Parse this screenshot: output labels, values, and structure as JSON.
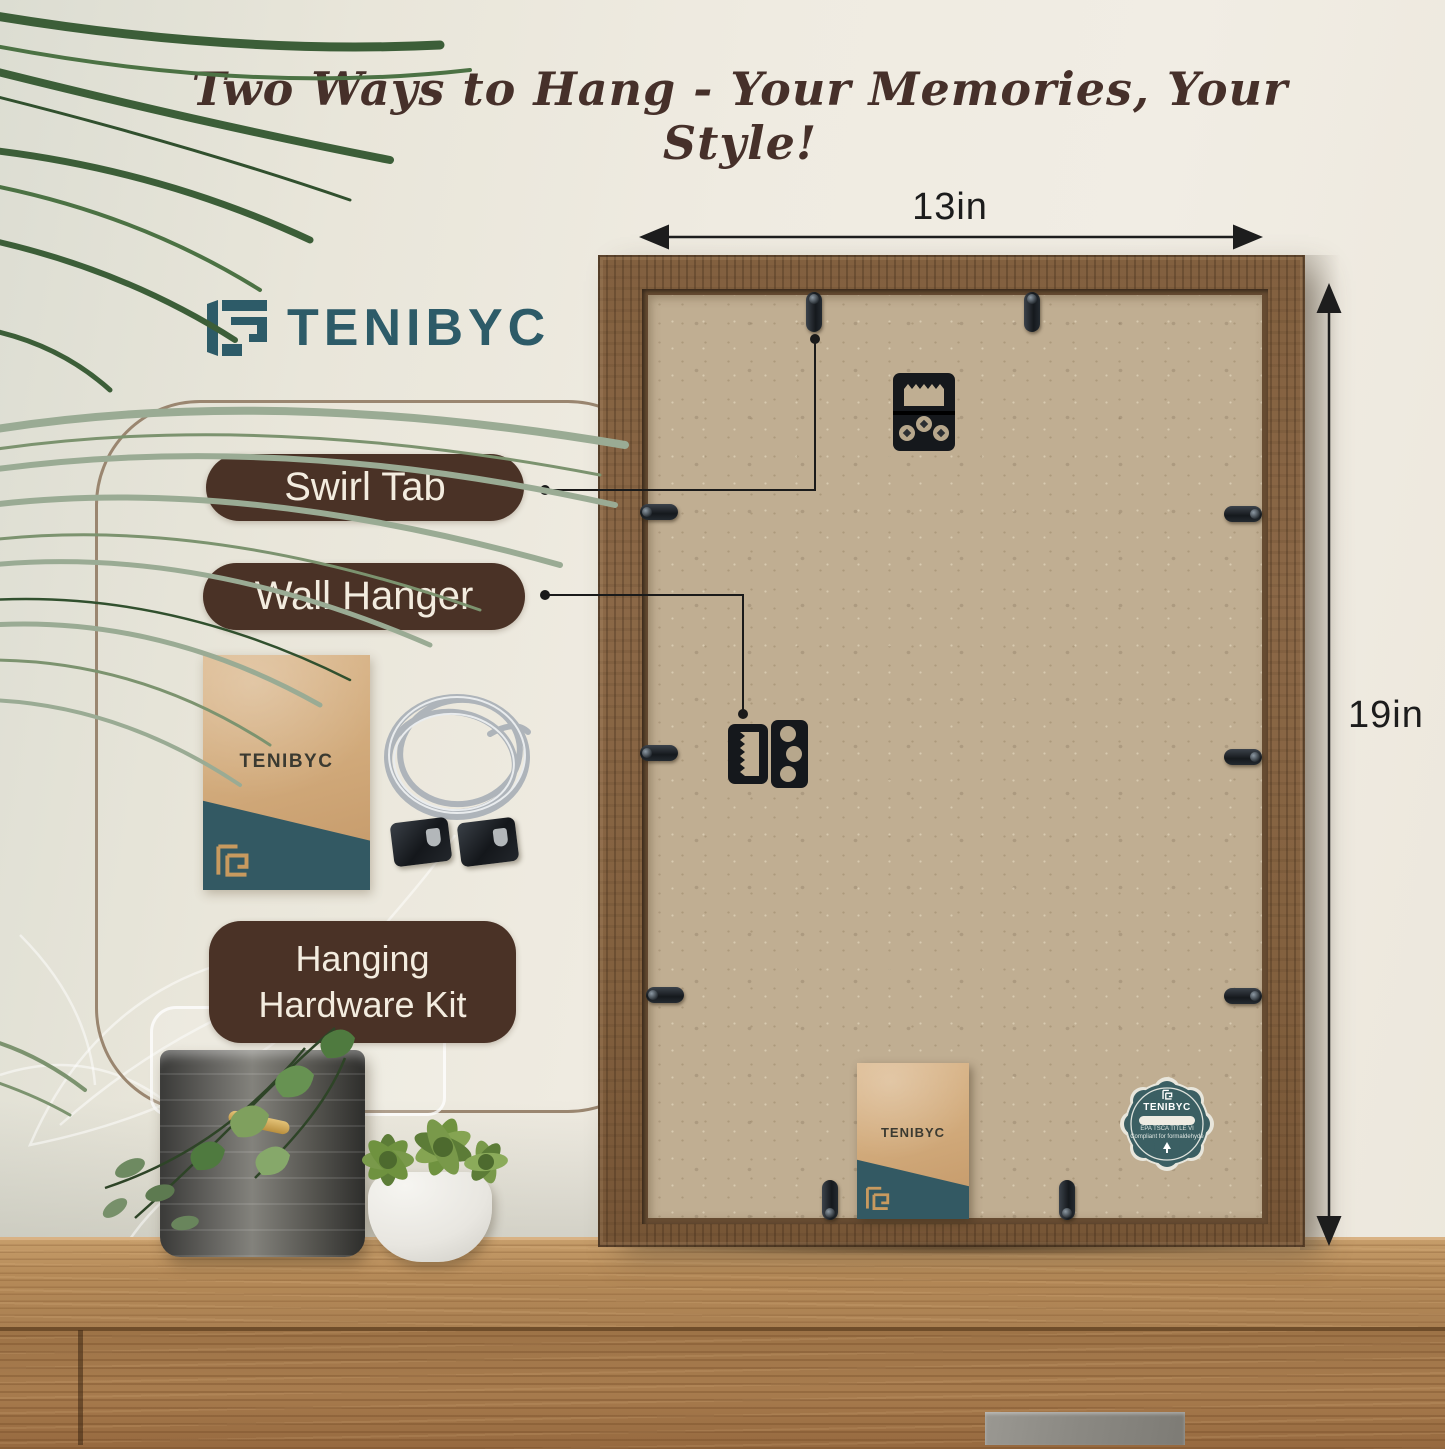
{
  "headline": {
    "text": "Two Ways to Hang - Your Memories, Your Style!",
    "color": "#46302a"
  },
  "brand": {
    "name": "TENIBYC",
    "accent_color": "#2d5b68"
  },
  "panel": {
    "labels": {
      "swirl_tab": "Swirl Tab",
      "wall_hanger": "Wall Hanger",
      "kit_line1": "Hanging",
      "kit_line2": "Hardware Kit"
    },
    "label_bg_color": "#4a3226",
    "envelope_brand": "TENIBYC"
  },
  "frame": {
    "width_label": "13in",
    "height_label": "19in",
    "wood_color": "#8a6645",
    "backing_color": "#c0ae92",
    "bottom_envelope_brand": "TENIBYC"
  },
  "badge": {
    "brand": "TENIBYC",
    "cert_line1": "EPA TSCA TITLE VI",
    "cert_line2": "Compliant for formaldehyde",
    "teal_color": "#3b5f63"
  }
}
